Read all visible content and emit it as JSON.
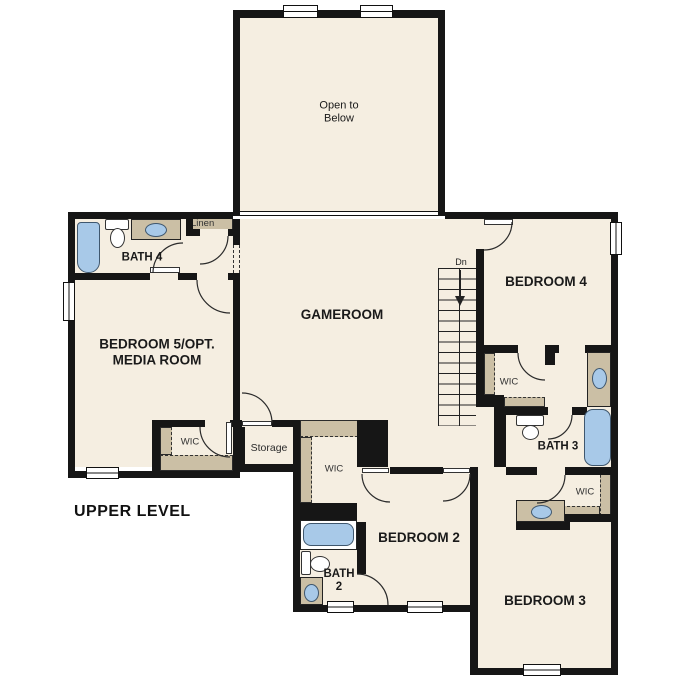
{
  "plan": {
    "level_title": "UPPER LEVEL",
    "colors": {
      "floor": "#f5eee1",
      "wall": "#161616",
      "counter": "#cbbfa5",
      "fixture": "#a8c9e8"
    },
    "rooms": {
      "open_to_below": "Open to Below",
      "gameroom": "GAMEROOM",
      "bedroom4": "BEDROOM 4",
      "bedroom5": "BEDROOM 5/OPT. MEDIA ROOM",
      "bedroom2": "BEDROOM 2",
      "bedroom3": "BEDROOM 3",
      "bath4": "BATH 4",
      "bath3": "BATH 3",
      "bath2": "BATH 2"
    },
    "closets": {
      "linen": "Linen",
      "storage": "Storage",
      "wic_bedroom5": "WIC",
      "wic_bedroom2": "WIC",
      "wic_bedroom4": "WIC",
      "wic_bedroom3": "WIC"
    },
    "stairs": {
      "direction_label": "Dn"
    }
  }
}
